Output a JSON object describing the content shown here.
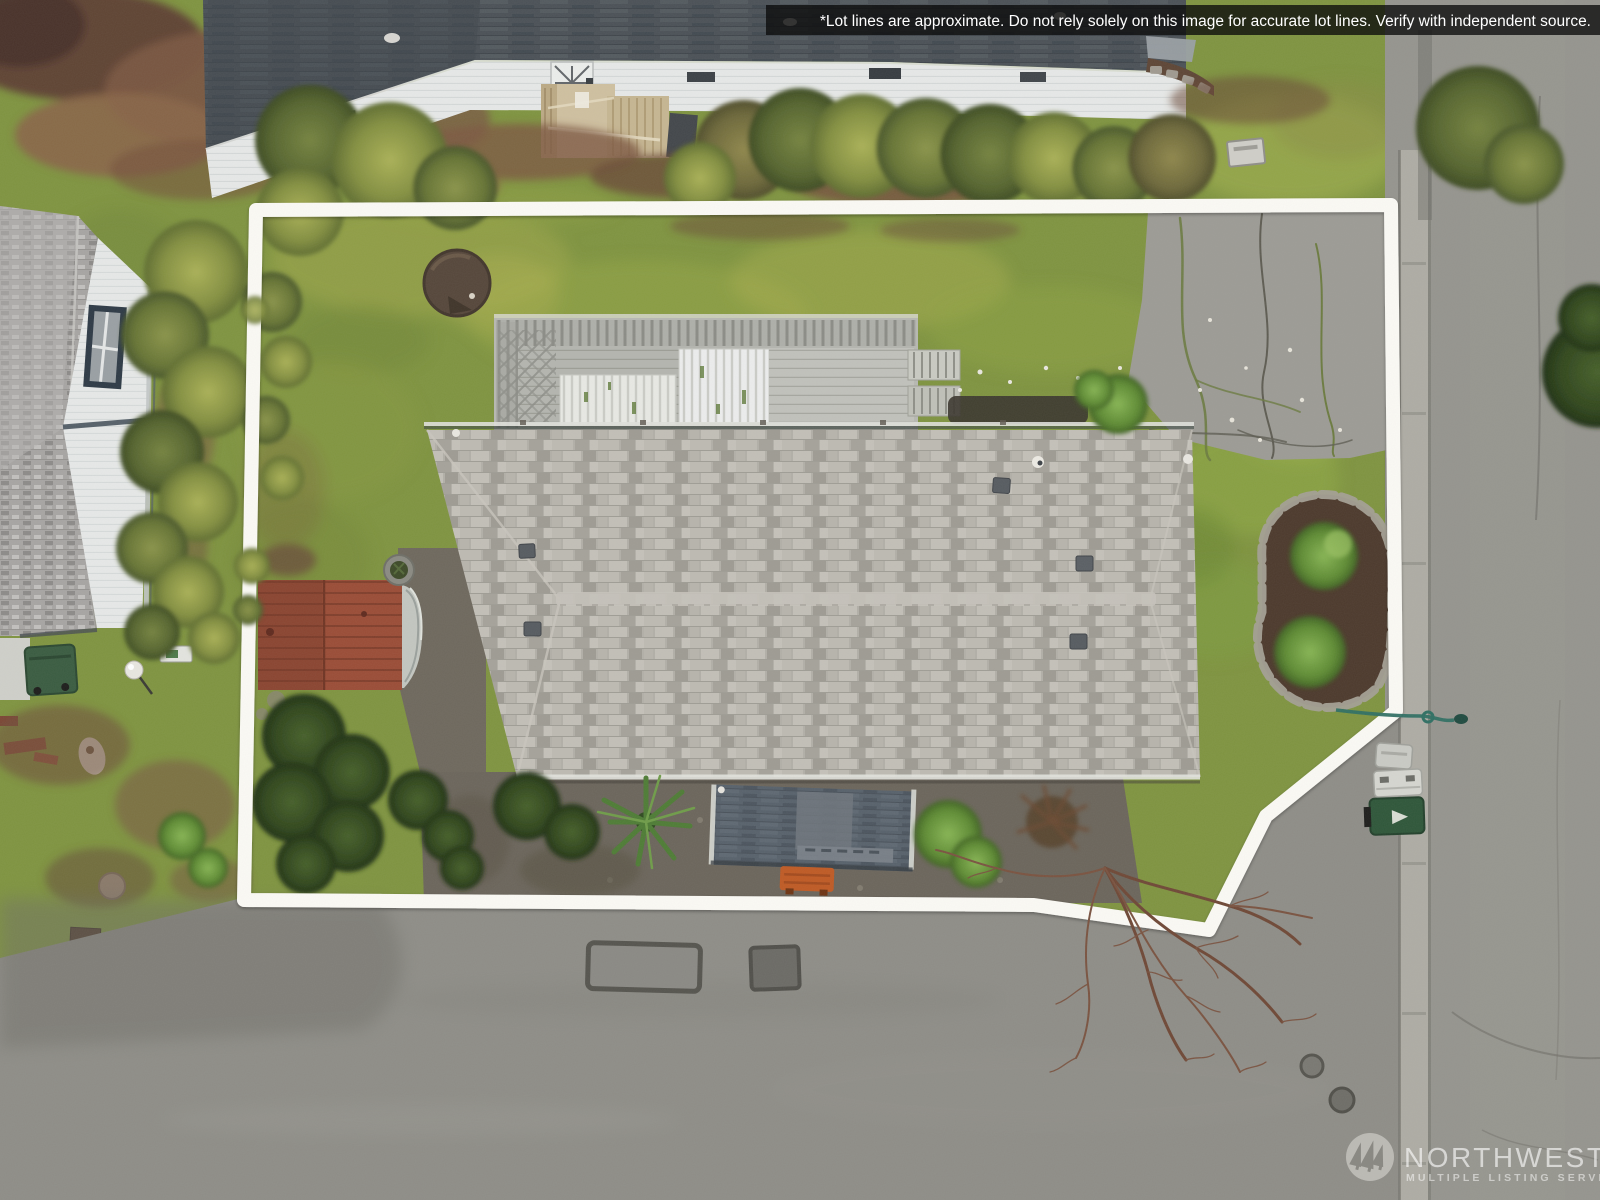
{
  "overlay": {
    "disclaimer_text": "*Lot lines are approximate. Do not rely solely on this image for accurate lot lines. Verify with independent source.",
    "watermark": {
      "title": "NORTHWEST",
      "subtitle": "MULTIPLE LISTING SERVICE"
    }
  },
  "scene": {
    "type": "aerial-drone-photo",
    "description": "Top-down aerial photo of a single-story home with white approximate lot-line overlay, neighboring homes, lawns, shed, driveway and streets",
    "palette": {
      "lot_line": "#fbfaf5",
      "asphalt_road": "#8e8d87",
      "right_road": "#95948e",
      "curb": "#aeaca4",
      "moss": "#7f9440",
      "lawn": "#8b9c44",
      "lawn_bright": "#8fae43",
      "leaf_litter": "#7d5742",
      "main_roof": "#b2afa7",
      "neighbor_roof_dark": "#4b5157",
      "left_roof": "#a7a5a3",
      "siding_white": "#e7e9e8",
      "deck_wood": "#b7b8b2",
      "deck_panel": "#e8e9e4",
      "stair_wood": "#cfc0a0",
      "shed_red": "#9a4c36",
      "carport_roof": "#57616b",
      "bench_orange": "#bf5a24",
      "gravel": "#6b655b",
      "driveway": "#9c9b95",
      "mulch": "#4c392c",
      "bush_dark": "#33491f",
      "bush_bright": "#619030",
      "conifer": "#6f7d3a",
      "bin_green": "#2e5639",
      "bin_white": "#d5d6d0",
      "fire_pit": "#55463a"
    }
  }
}
